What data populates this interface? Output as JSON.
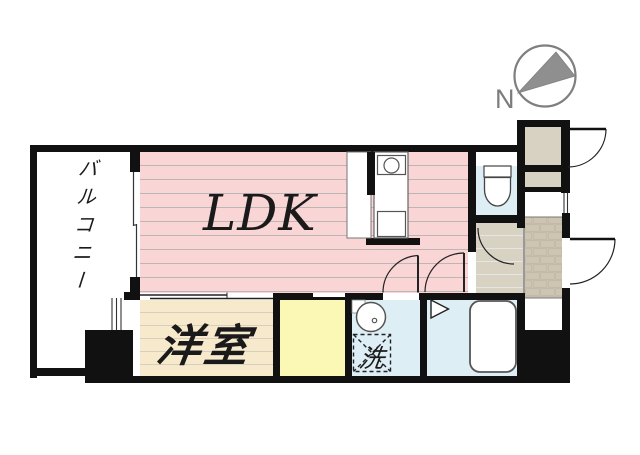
{
  "floor_plan": {
    "compass": {
      "north_label": "N"
    },
    "rooms": {
      "balcony": {
        "label": "バルコニー"
      },
      "ldk": {
        "label": "LDK"
      },
      "western_room": {
        "label": "洋室"
      },
      "laundry_space": {
        "label": "洗"
      }
    },
    "colors": {
      "wall_black": "#111111",
      "ldk_pink": "#f9d5d6",
      "western_room_beige": "#f7e9cc",
      "closet_yellow": "#fbf8b5",
      "wet_area_blue": "#ddeef5",
      "hallway_greige": "#d8d2c2",
      "entry_brick_greige": "#cdc5b2",
      "compass_gray": "#8a8a8a",
      "background_white": "#ffffff"
    }
  }
}
